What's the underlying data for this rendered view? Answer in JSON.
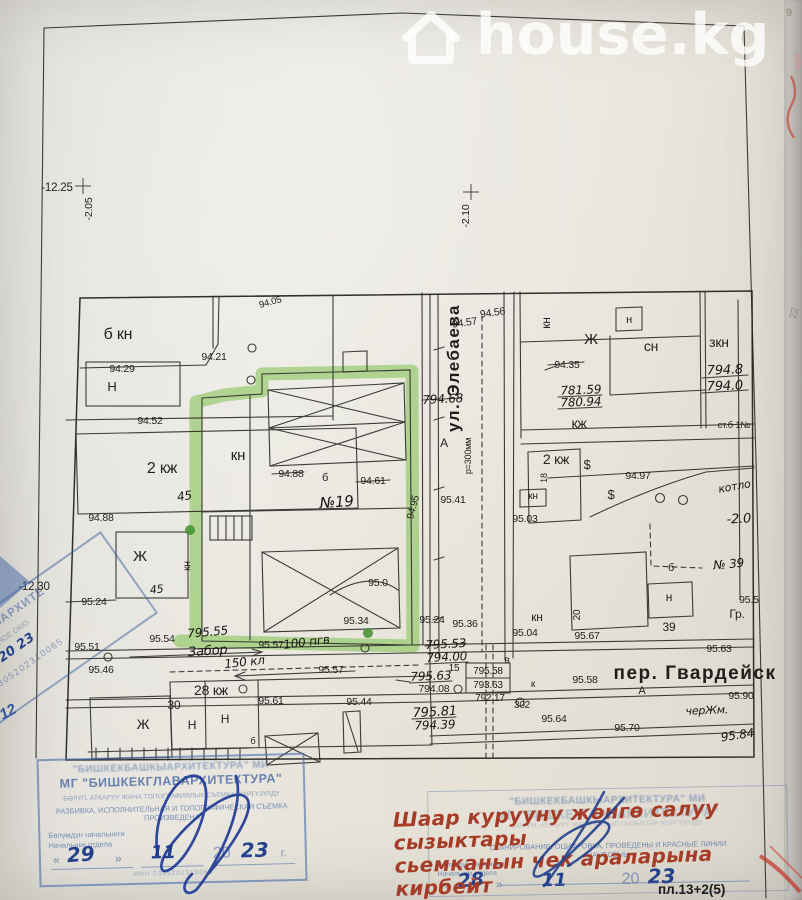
{
  "colors": {
    "highlight_green": "#86c558",
    "stamp_blue": "#4a69a5",
    "red_ink": "#a63c28",
    "watermark_white": "#ffffff",
    "map_ink": "#2e2d28"
  },
  "watermark": {
    "label": "house.kg",
    "icon": "house-icon"
  },
  "map": {
    "labels": [
      {
        "t": "-12.25",
        "x": 57,
        "y": 191,
        "fs": 11.5,
        "n": "bench-mark-12-25"
      },
      {
        "t": "-2.05",
        "x": 92,
        "y": 209,
        "fs": 10.5,
        "r": -90
      },
      {
        "t": "-2.10",
        "x": 469,
        "y": 216,
        "fs": 10.5,
        "r": -90
      },
      {
        "t": "-12.30",
        "x": 34,
        "y": 590,
        "fs": 11.5
      },
      {
        "t": "9",
        "x": 789,
        "y": 16,
        "fs": 11,
        "c": "pencil"
      },
      {
        "t": "22",
        "x": 797,
        "y": 314,
        "fs": 10,
        "r": -75,
        "c": "pencil"
      },
      {
        "t": "12",
        "x": 10,
        "y": 716,
        "fs": 15,
        "r": -28,
        "c": "bluehw"
      },
      {
        "t": "б кн",
        "x": 118,
        "y": 339,
        "fs": 16
      },
      {
        "t": "94.29",
        "x": 122,
        "y": 372,
        "fs": 10.5
      },
      {
        "t": "Н",
        "x": 112,
        "y": 391,
        "fs": 13
      },
      {
        "t": "94.52",
        "x": 150,
        "y": 424,
        "fs": 10.5
      },
      {
        "t": "2 кж",
        "x": 162,
        "y": 473,
        "fs": 16
      },
      {
        "t": "45",
        "x": 185,
        "y": 500,
        "fs": 12,
        "r": -8,
        "c": "hw"
      },
      {
        "t": "кн",
        "x": 238,
        "y": 460,
        "fs": 15
      },
      {
        "t": "94.21",
        "x": 214,
        "y": 360,
        "fs": 10.5
      },
      {
        "t": "94.05",
        "x": 271,
        "y": 305,
        "fs": 9.5,
        "r": -15
      },
      {
        "t": "94.88",
        "x": 291,
        "y": 477,
        "fs": 10.5
      },
      {
        "t": "б",
        "x": 325,
        "y": 481,
        "fs": 11
      },
      {
        "t": "94.61",
        "x": 373,
        "y": 484,
        "fs": 10.5
      },
      {
        "t": "№19",
        "x": 337,
        "y": 507,
        "fs": 15,
        "r": -4,
        "c": "hw",
        "n": "plot-number"
      },
      {
        "t": "94.95",
        "x": 416,
        "y": 508,
        "fs": 10,
        "r": -75
      },
      {
        "t": "94.88",
        "x": 101,
        "y": 521,
        "fs": 10.5
      },
      {
        "t": "Ж",
        "x": 140,
        "y": 561,
        "fs": 15
      },
      {
        "t": "кн",
        "x": 190,
        "y": 566,
        "fs": 10,
        "r": -90
      },
      {
        "t": "45",
        "x": 157,
        "y": 593,
        "fs": 11,
        "r": -6,
        "c": "hw"
      },
      {
        "t": "95.0",
        "x": 378,
        "y": 586,
        "fs": 10.5
      },
      {
        "t": "95.34",
        "x": 356,
        "y": 624,
        "fs": 10.5
      },
      {
        "t": "95.24",
        "x": 94,
        "y": 605,
        "fs": 10.5
      },
      {
        "t": "95.51",
        "x": 87,
        "y": 650,
        "fs": 10.5
      },
      {
        "t": "95.46",
        "x": 101,
        "y": 673,
        "fs": 10.5
      },
      {
        "t": "95.54",
        "x": 162,
        "y": 642,
        "fs": 10.5
      },
      {
        "t": "795.55",
        "x": 208,
        "y": 636,
        "fs": 12,
        "r": -5,
        "c": "hw"
      },
      {
        "t": "Забор",
        "x": 208,
        "y": 655,
        "fs": 13,
        "r": -4,
        "c": "hw"
      },
      {
        "t": "150 кл",
        "x": 245,
        "y": 666,
        "fs": 12,
        "r": -6,
        "c": "hw"
      },
      {
        "t": "95.57",
        "x": 271,
        "y": 648,
        "fs": 10.5
      },
      {
        "t": "100 пгв",
        "x": 307,
        "y": 646,
        "fs": 12,
        "r": -7,
        "c": "hw"
      },
      {
        "t": "95.57",
        "x": 331,
        "y": 673,
        "fs": 10.5
      },
      {
        "t": "28 кж",
        "x": 211,
        "y": 695,
        "fs": 14
      },
      {
        "t": "30",
        "x": 174,
        "y": 709,
        "fs": 12
      },
      {
        "t": "Ж",
        "x": 143,
        "y": 729,
        "fs": 14
      },
      {
        "t": "Н",
        "x": 192,
        "y": 729,
        "fs": 12
      },
      {
        "t": "Н",
        "x": 225,
        "y": 723,
        "fs": 12
      },
      {
        "t": "б",
        "x": 253,
        "y": 744,
        "fs": 9
      },
      {
        "t": "95.61",
        "x": 271,
        "y": 704,
        "fs": 10.5
      },
      {
        "t": "95.44",
        "x": 359,
        "y": 705,
        "fs": 10.5
      },
      {
        "t": "95.24",
        "x": 432,
        "y": 623,
        "fs": 10.5
      },
      {
        "t": "95.36",
        "x": 465,
        "y": 627,
        "fs": 10.5
      },
      {
        "t": "795.53",
        "x": 446,
        "y": 648,
        "fs": 12,
        "r": -3,
        "c": "hw"
      },
      {
        "t": "794.00",
        "x": 447,
        "y": 661,
        "fs": 12,
        "r": -3,
        "c": "hw"
      },
      {
        "t": "15",
        "x": 454,
        "y": 671,
        "fs": 10
      },
      {
        "t": "795.63",
        "x": 431,
        "y": 680,
        "fs": 12,
        "r": -2,
        "c": "hw"
      },
      {
        "t": "794.08",
        "x": 434,
        "y": 692,
        "fs": 10.5
      },
      {
        "t": "795.58",
        "x": 488,
        "y": 674,
        "fs": 10
      },
      {
        "t": "793.63",
        "x": 488,
        "y": 688,
        "fs": 10
      },
      {
        "t": "792.17",
        "x": 490,
        "y": 701,
        "fs": 10
      },
      {
        "t": "302",
        "x": 522,
        "y": 708,
        "fs": 10
      },
      {
        "t": "795.81",
        "x": 435,
        "y": 716,
        "fs": 13,
        "r": -3,
        "c": "hw"
      },
      {
        "t": "794.39",
        "x": 435,
        "y": 729,
        "fs": 12,
        "r": -2,
        "c": "hw"
      },
      {
        "t": "кн",
        "x": 537,
        "y": 621,
        "fs": 12
      },
      {
        "t": "95.04",
        "x": 525,
        "y": 636,
        "fs": 10.5
      },
      {
        "t": "20",
        "x": 580,
        "y": 615,
        "fs": 10,
        "r": -90
      },
      {
        "t": "95.67",
        "x": 587,
        "y": 639,
        "fs": 10.5
      },
      {
        "t": "в",
        "x": 507,
        "y": 663,
        "fs": 10
      },
      {
        "t": "к",
        "x": 533,
        "y": 687,
        "fs": 10
      },
      {
        "t": "95.58",
        "x": 585,
        "y": 683,
        "fs": 10.5
      },
      {
        "t": "95.64",
        "x": 554,
        "y": 722,
        "fs": 10.5
      },
      {
        "t": "95.70",
        "x": 627,
        "y": 731,
        "fs": 10.5
      },
      {
        "t": "пер. Гвардейск",
        "x": 695,
        "y": 679,
        "fs": 19,
        "c": "street",
        "n": "street-gvardeysky-label"
      },
      {
        "t": "А",
        "x": 642,
        "y": 694,
        "fs": 11
      },
      {
        "t": "95.90",
        "x": 741,
        "y": 699,
        "fs": 10.5
      },
      {
        "t": "черЖм.",
        "x": 707,
        "y": 714,
        "fs": 11,
        "r": -2,
        "c": "hw"
      },
      {
        "t": "95.84",
        "x": 738,
        "y": 739,
        "fs": 12,
        "r": -8,
        "c": "hw"
      },
      {
        "t": "95.63",
        "x": 719,
        "y": 652,
        "fs": 10.5
      },
      {
        "t": "95.5",
        "x": 749,
        "y": 603,
        "fs": 10.5
      },
      {
        "t": "Гр.",
        "x": 737,
        "y": 618,
        "fs": 12
      },
      {
        "t": "39",
        "x": 669,
        "y": 631,
        "fs": 12
      },
      {
        "t": "№ 39",
        "x": 729,
        "y": 568,
        "fs": 12,
        "r": -5,
        "c": "hw"
      },
      {
        "t": "-2.0",
        "x": 739,
        "y": 523,
        "fs": 13,
        "r": -3,
        "c": "hw"
      },
      {
        "t": "котло",
        "x": 735,
        "y": 490,
        "fs": 11,
        "r": -10,
        "c": "hw"
      },
      {
        "t": "94.97",
        "x": 638,
        "y": 479,
        "fs": 10.5
      },
      {
        "t": "$",
        "x": 611,
        "y": 499,
        "fs": 13
      },
      {
        "t": "$",
        "x": 587,
        "y": 469,
        "fs": 13
      },
      {
        "t": "н",
        "x": 629,
        "y": 323,
        "fs": 11
      },
      {
        "t": "Ж",
        "x": 591,
        "y": 344,
        "fs": 15
      },
      {
        "t": "сн",
        "x": 651,
        "y": 351,
        "fs": 14
      },
      {
        "t": "зкн",
        "x": 719,
        "y": 347,
        "fs": 14
      },
      {
        "t": "794.8",
        "x": 725,
        "y": 374,
        "fs": 13,
        "r": -2,
        "c": "hw"
      },
      {
        "t": "794.0",
        "x": 725,
        "y": 390,
        "fs": 13,
        "r": -2,
        "c": "hw"
      },
      {
        "t": "94.35",
        "x": 567,
        "y": 368,
        "fs": 10.5
      },
      {
        "t": "781.59",
        "x": 581,
        "y": 394,
        "fs": 12,
        "r": -2,
        "c": "hw"
      },
      {
        "t": "780.94",
        "x": 581,
        "y": 406,
        "fs": 12,
        "r": -2,
        "c": "hw"
      },
      {
        "t": "кж",
        "x": 579,
        "y": 428,
        "fs": 14
      },
      {
        "t": "ст.б 1№",
        "x": 734,
        "y": 428,
        "fs": 9.5
      },
      {
        "t": "2 кж",
        "x": 556,
        "y": 464,
        "fs": 14
      },
      {
        "t": "18",
        "x": 547,
        "y": 478,
        "fs": 9,
        "r": -90
      },
      {
        "t": "кн",
        "x": 550,
        "y": 323,
        "fs": 12,
        "r": -90
      },
      {
        "t": "94.57",
        "x": 465,
        "y": 326,
        "fs": 10.5,
        "r": -8
      },
      {
        "t": "94.56",
        "x": 493,
        "y": 316,
        "fs": 10.5,
        "r": -8
      },
      {
        "t": "794.68",
        "x": 443,
        "y": 403,
        "fs": 12,
        "r": -3,
        "c": "hw"
      },
      {
        "t": "95.41",
        "x": 453,
        "y": 503,
        "fs": 10.5
      },
      {
        "t": "95.03",
        "x": 525,
        "y": 522,
        "fs": 10.5
      },
      {
        "t": "кн",
        "x": 533,
        "y": 499,
        "fs": 10
      },
      {
        "t": "ул. Элебаева",
        "x": 459,
        "y": 368,
        "fs": 17,
        "r": -90,
        "c": "street",
        "n": "street-elebaeva-label"
      },
      {
        "t": "А",
        "x": 444,
        "y": 447,
        "fs": 12
      },
      {
        "t": "р=300мм",
        "x": 471,
        "y": 456,
        "fs": 9,
        "r": -90
      },
      {
        "t": "б",
        "x": 671,
        "y": 571,
        "fs": 11
      },
      {
        "t": "н",
        "x": 669,
        "y": 601,
        "fs": 12
      }
    ]
  },
  "stamps": {
    "left": {
      "org_line1": "\"БИШКЕКБАШКЫАРХИТЕКТУРА\" МИ",
      "org_line2": "МГ \"БИШКЕКГЛАВАРХИТЕКТУРА\"",
      "kg_line": "БӨЛҮП, АТКАРУУ ЖАНА ТОПОГРАФИЯЛЫК СЪЕМКА ЖҮРГҮЗҮЛДҮ",
      "ru_line1": "РАЗБИВКА, ИСПОЛНИТЕЛЬНАЯ И ТОПОГРАФИЧЕСКАЯ СЪЕМКА",
      "ru_line2": "ПРОИЗВЕДЕНА",
      "head_kg": "Бөлүмдүн начальниги",
      "head_ru": "Начальник отдела",
      "q1": "«",
      "day": "29",
      "q2": "»",
      "month": "11",
      "year_pre": "20",
      "year": "23",
      "year_suffix": "г.",
      "inn": "ИНН 0305202310065"
    },
    "right": {
      "org_line1": "\"БИШКЕКБАШКЫАРХИТЕКТУРА\" МИ",
      "org_line2": "МГ \"БИШКЕКГЛАВАРХИТЕКТУРА\"",
      "kg_line": "БӨЛҮМ, АТКАРУУ ЖАНА КЫЗЫЛ СЫЗЫКТАР ЖҮРГҮЗҮЛДҮ",
      "ru_line1": "СКАНИРОВАНИЕ, ОЦИФРОВКА, ПРОВЕДЕНЫ И КРАСНЫЕ ЛИНИИ",
      "ru_line2": "НАНЕСЕНЫ",
      "head_kg": "Бөлүмдүн начальниги",
      "head_ru": "Начальник отдела",
      "q1": "«",
      "day": "28",
      "q2": "»",
      "month": "11",
      "year_pre": "20",
      "year": "23",
      "plate": "пл.13+2(5)"
    },
    "red_note": {
      "line1": "Шаар курууну жөнгө салуу сызыктары",
      "line2": "сьемканын чек араларына кирбейт"
    },
    "diagonal": {
      "line1": "КЕКГЛАВАРХИТЕ",
      "line2": "ЛТАНОЕ ОКЮ.",
      "date": "20 23",
      "number": "0305202310065"
    }
  }
}
